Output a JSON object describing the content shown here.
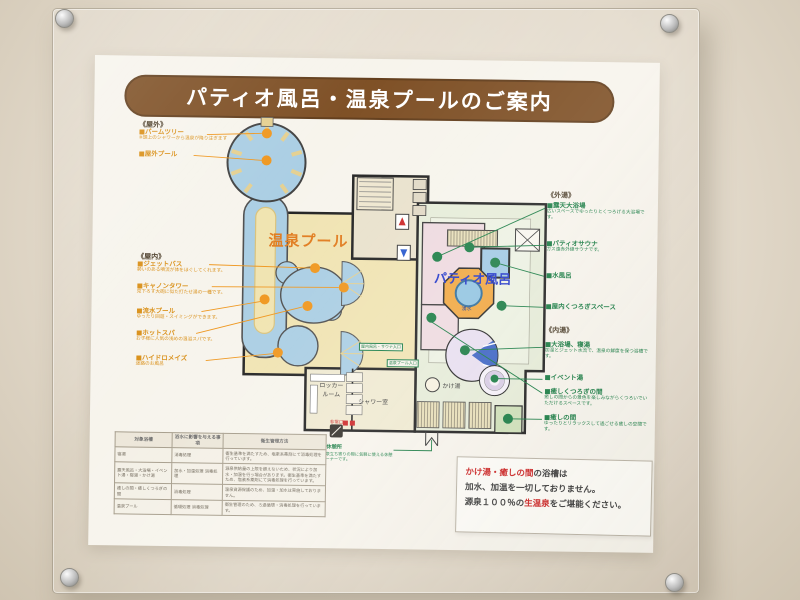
{
  "title": "パティオ風呂・温泉プールのご案内",
  "legend": {
    "outdoor": {
      "header": "《屋外》",
      "items": [
        {
          "name": "■パームツリー",
          "note": "※頭上のシャワーから温泉が降り注ぎます"
        },
        {
          "name": "■屋外プール",
          "note": ""
        }
      ]
    },
    "indoor": {
      "header": "《屋内》",
      "items": [
        {
          "name": "■ジェットバス",
          "note": "勢いのある噴流が体をほぐしてくれます。"
        },
        {
          "name": "■キャノンタワー",
          "note": "見下ろす大砲に似た打たせ湯の一種です。"
        },
        {
          "name": "■流水プール",
          "note": "ゆったり回遊・スイミングができます。"
        },
        {
          "name": "■ホットスパ",
          "note": "お子様に人気の浅めの温浴スパです。"
        },
        {
          "name": "■ハイドロメイズ",
          "note": "迷路のお風呂"
        }
      ]
    },
    "sotoyu": {
      "header": "《外湯》",
      "items": [
        {
          "name": "■露天大浴場",
          "note": "広いスペースでゆったりとくつろげる大浴場です。"
        },
        {
          "name": "■パティオサウナ",
          "note": "ガス遠赤外線サウナです。"
        },
        {
          "name": "■水風呂",
          "note": ""
        },
        {
          "name": "■屋内くつろぎスペース",
          "note": ""
        }
      ]
    },
    "uchiyu": {
      "header": "《内湯》",
      "items": [
        {
          "name": "■大浴場、寝湯",
          "note": "加温とジェット水流で、温泉の鮮度を保つ浴槽です。"
        },
        {
          "name": "■イベント湯",
          "note": ""
        },
        {
          "name": "■癒しくつろぎの間",
          "note": "癒しの間からの景色を楽しみながらくつろいでいただけるスペースです。"
        },
        {
          "name": "■癒しの間",
          "note": "ゆったりとリラックスして過ごせる癒しの空間です。"
        }
      ]
    },
    "rest": {
      "name": "■休憩所",
      "note": "温泉立ち寄りの際に気軽に使える休憩コーナーです。"
    }
  },
  "map": {
    "pool_label": "温泉プール",
    "patio_label": "パティオ風呂",
    "spring_label": "湧水",
    "locker_label": "ロッカールーム",
    "shower_label": "シャワー室",
    "kakeyu_label": "かけ湯",
    "emergency_label": "非常口",
    "entrance_tag_1": "屋内風呂・サウナ入口",
    "entrance_tag_2": "温泉プール入口"
  },
  "notice": {
    "l1_red": "かけ湯・癒しの間",
    "l1_rest": "の浴槽は",
    "l2": "加水、加温を一切しておりません。",
    "l3_pre": "源泉１００％の",
    "l3_red": "生温泉",
    "l3_post": "をご堪能ください。"
  },
  "table": {
    "headers": [
      "対象浴槽",
      "浴水に影響を与える事項",
      "衛生管理方法"
    ],
    "rows": [
      {
        "target": "寝湯",
        "factor": "消毒処理",
        "method": "衛生基準を満たすため、塩素系薬剤にて消毒処理を行っています。"
      },
      {
        "target": "露天風呂・大浴場・イベント湯・寝湯・かけ湯",
        "factor": "加水・加温処理 消毒処理",
        "method": "源泉供給量の上限を超えないため、状況により加水・加温を行う場合があります。衛生基準を満たすため、塩素系薬剤にて消毒処理を行っています。"
      },
      {
        "target": "癒しの間・癒しくつろぎの間",
        "factor": "消毒処理",
        "method": "温泉資源保護のため、加温・加水は実施しておりません。"
      },
      {
        "target": "温泉プール",
        "factor": "循環処理 消毒処理",
        "method": "衛生管理のため、ろ過循環・消毒処理を行っています。"
      }
    ]
  },
  "colors": {
    "title_bg": "#7a4a1e",
    "orange_accent": "#d98d12",
    "green_accent": "#157a40",
    "notice_red": "#cc2020",
    "pool_blue": "#a8cde3"
  }
}
